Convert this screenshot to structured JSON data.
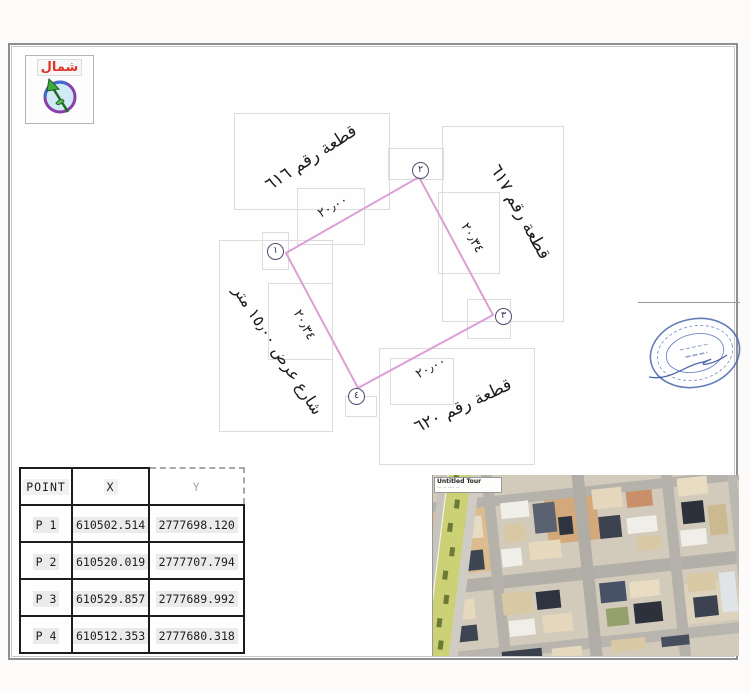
{
  "north": {
    "label": "شمال"
  },
  "parcel": {
    "plot_616": "قطعة رقم ٦١٦",
    "plot_617": "قطعة رقم ٦١٧",
    "plot_620": "قطعة رقم ٦٢٠",
    "street": "شارع عرض ١٥٫٠٠ متر",
    "dim_top": "٢٠٫٠٠",
    "dim_bottom": "٢٠٫٠٠",
    "dim_left": "٢٠٫٣٤",
    "dim_right": "٢٠٫٣٤",
    "vertex_1": "١",
    "vertex_2": "٢",
    "vertex_3": "٣",
    "vertex_4": "٤",
    "line_color": "#dc9fd6"
  },
  "table": {
    "headers": [
      "POINT",
      "X",
      "Y"
    ],
    "rows": [
      [
        "P 1",
        "610502.514",
        "2777698.120"
      ],
      [
        "P 2",
        "610520.019",
        "2777707.794"
      ],
      [
        "P 3",
        "610529.857",
        "2777689.992"
      ],
      [
        "P 4",
        "610512.353",
        "2777680.318"
      ]
    ]
  },
  "map": {
    "label_title": "Untitled Tour",
    "label_note": "··· ·· ···· ··"
  }
}
